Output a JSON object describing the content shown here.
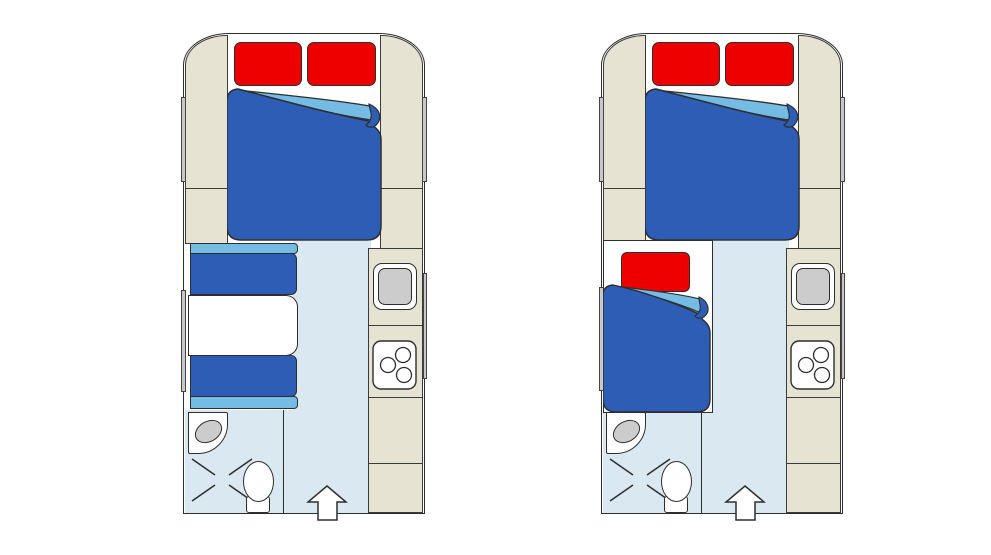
{
  "figure": {
    "kind": "caravan-floor-plans-top-view",
    "plan_count": 2,
    "background": "#ffffff"
  },
  "palette": {
    "outline": "#2e2e2e",
    "furniture_beige": "#e6e3d2",
    "floor_light_blue": "#dae8f2",
    "bedding_dark_blue": "#2d5db5",
    "bedding_fold_light_blue": "#74bce4",
    "pillow_red": "#ee0000",
    "fixture_gray": "#cccccc",
    "window_gray": "#c8c8c8",
    "white": "#ffffff"
  },
  "plans": [
    {
      "name": "floorplan-left",
      "elements": [
        "front-double-bed-with-folded-duvet",
        "two-red-pillows",
        "dinette-two-benches-with-table",
        "side-windows",
        "wardrobe-cabinets",
        "kitchen-sink",
        "three-burner-hob",
        "washbasin",
        "shower-tray",
        "toilet",
        "entrance-arrow"
      ]
    },
    {
      "name": "floorplan-right",
      "elements": [
        "front-double-bed-with-folded-duvet",
        "two-red-pillows",
        "single-bed-with-red-pillow-and-folded-duvet",
        "side-windows",
        "wardrobe-cabinets",
        "kitchen-sink",
        "three-burner-hob",
        "washbasin",
        "shower-tray",
        "toilet",
        "entrance-arrow"
      ]
    }
  ]
}
